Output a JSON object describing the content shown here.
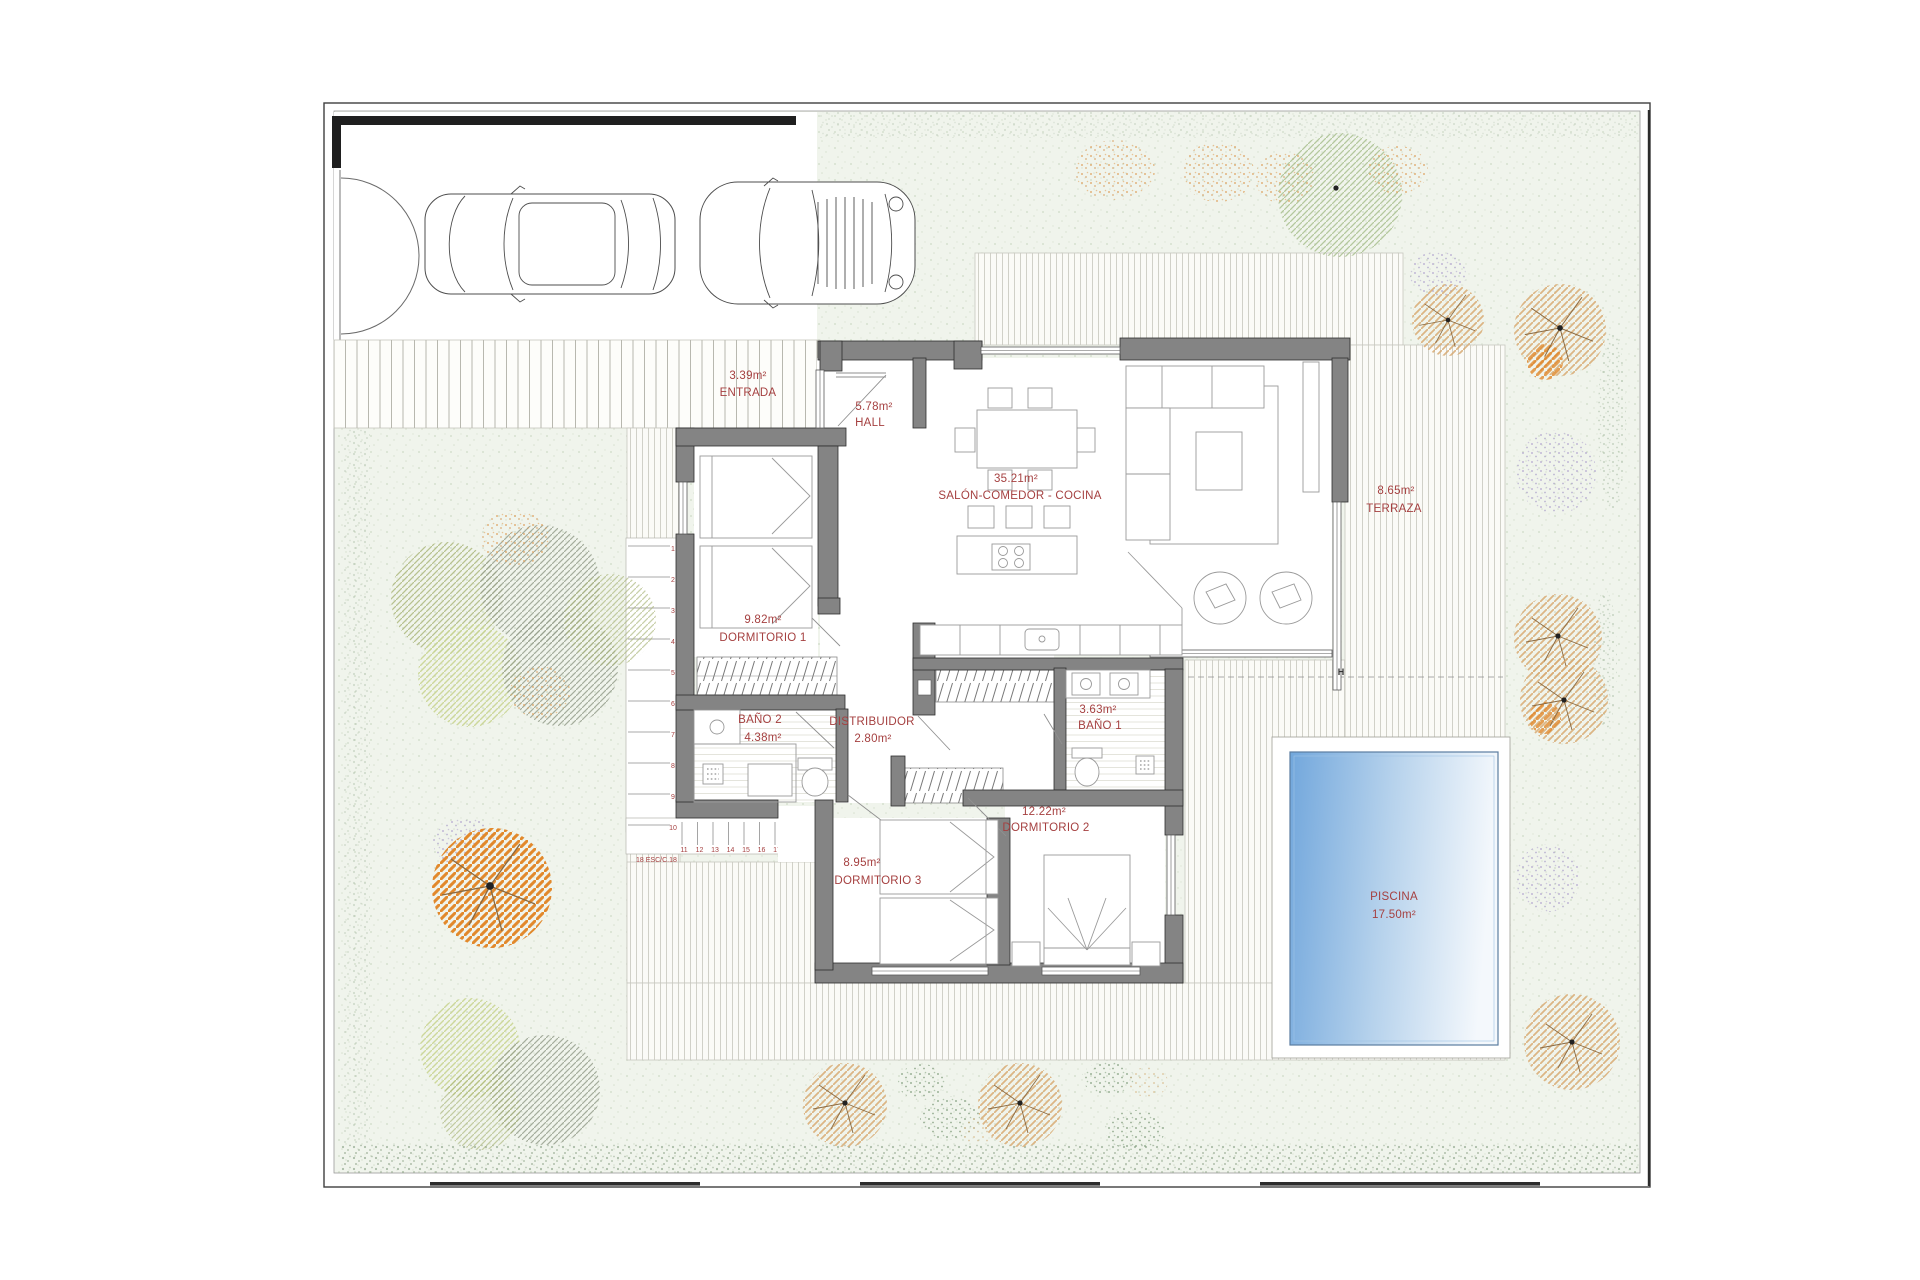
{
  "plan": {
    "title": "villa-floor-plan",
    "rooms": [
      {
        "key": "entrada",
        "area": "3.39m²",
        "name": "ENTRADA"
      },
      {
        "key": "hall",
        "area": "5.78m²",
        "name": "HALL"
      },
      {
        "key": "salon",
        "area": "35.21m²",
        "name": "SALÓN-COMEDOR - COCINA"
      },
      {
        "key": "terraza",
        "area": "8.65m²",
        "name": "TERRAZA"
      },
      {
        "key": "dormitorio1",
        "area": "9.82m²",
        "name": "DORMITORIO 1"
      },
      {
        "key": "bano2",
        "name": "BAÑO 2",
        "area": "4.38m²"
      },
      {
        "key": "distribuidor",
        "name": "DISTRIBUIDOR",
        "area": "2.80m²"
      },
      {
        "key": "bano1",
        "area": "3.63m²",
        "name": "BAÑO 1"
      },
      {
        "key": "dormitorio2",
        "area": "12.22m²",
        "name": "DORMITORIO 2"
      },
      {
        "key": "dormitorio3",
        "area": "8.95m²",
        "name": "DORMITORIO 3"
      },
      {
        "key": "piscina",
        "name": "PISCINA",
        "area": "17.50m²"
      }
    ],
    "stairs": {
      "flight1": [
        "1",
        "2",
        "3",
        "4",
        "5",
        "6",
        "7",
        "8",
        "9",
        "10"
      ],
      "flight2": [
        "11",
        "12",
        "13",
        "14",
        "15",
        "16",
        "17"
      ],
      "last_step": "18",
      "note": "18 ESC/C.18"
    },
    "markers": {
      "hose_bib": "H"
    },
    "colors": {
      "label_red": "#A54040",
      "wall_gray": "#848484",
      "pool_blue": "#72A7DC",
      "deck_line": "#CCCCC3",
      "garden_green": "#F0F4EC",
      "hedge_green": "#93A98E",
      "tree_orange": "#E07D17",
      "tree_tan": "#D8AA72",
      "bush_purple": "#B4A8D0"
    }
  }
}
